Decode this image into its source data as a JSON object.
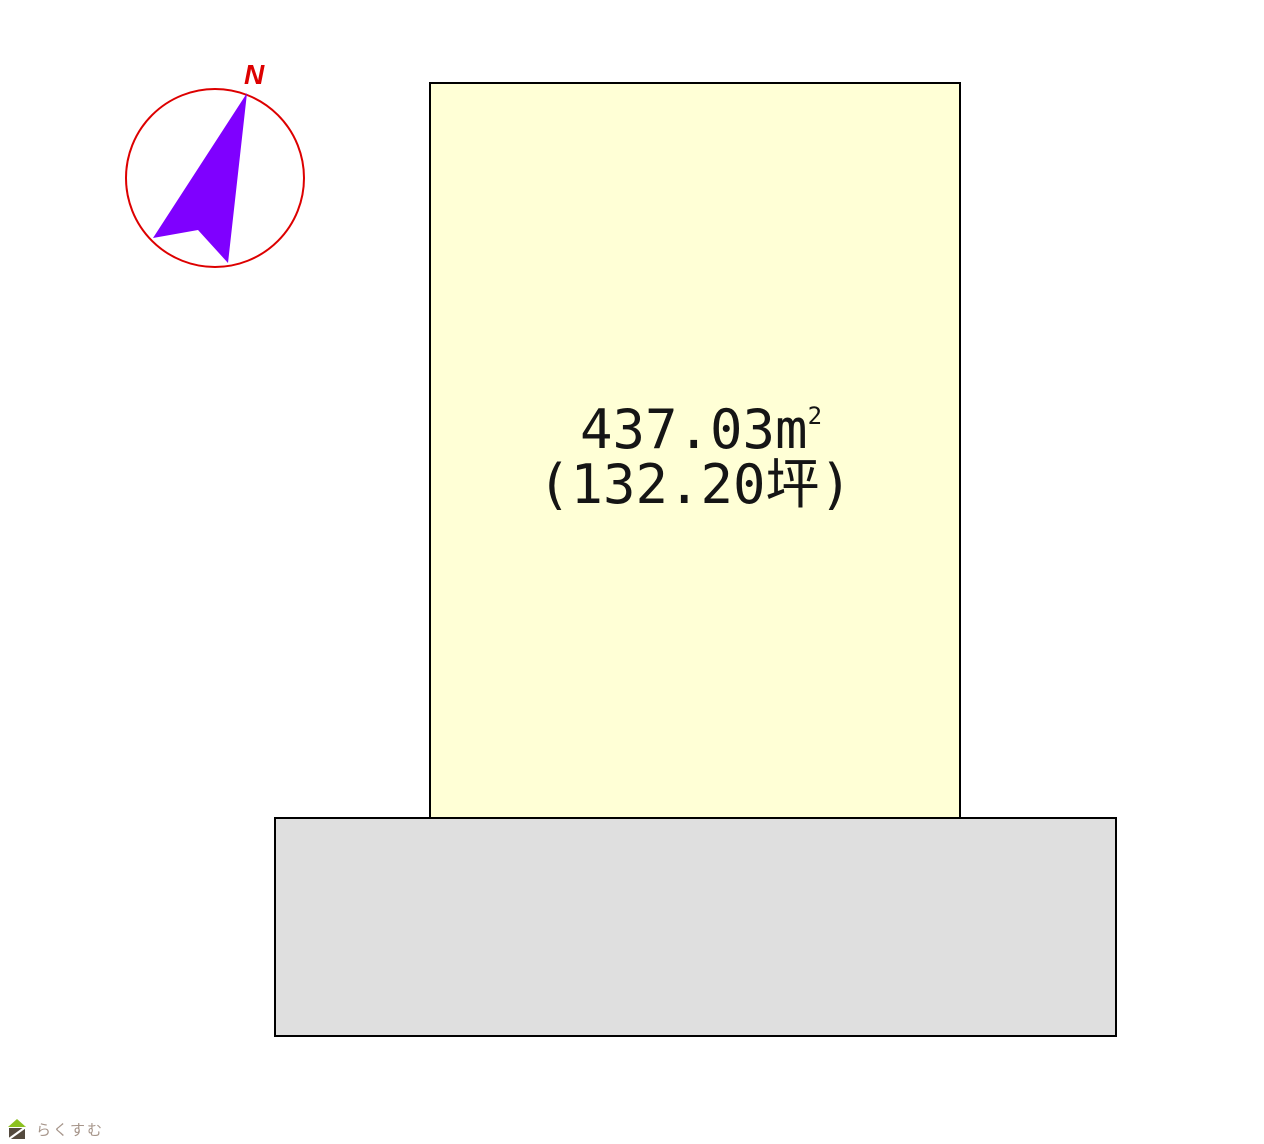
{
  "page": {
    "background_color": "#ffffff",
    "width": 1264,
    "height": 1144
  },
  "compass": {
    "north_label": "N",
    "circle_color": "#dd0000",
    "needle_color": "#7f00ff"
  },
  "plot": {
    "area_label": "437.03㎡",
    "area_value": "437.03",
    "area_unit_base": "m",
    "area_unit_exponent": "2",
    "tsubo_label": "(132.20坪)",
    "fill_color": "#ffffd6",
    "border_color": "#000000"
  },
  "road": {
    "fill_color": "#dfdfdf",
    "border_color": "#000000"
  },
  "logo": {
    "text": "らくすむ",
    "text_color": "#a6958a",
    "house_roof_color": "#8cc120",
    "house_body_color": "#544a3e"
  }
}
